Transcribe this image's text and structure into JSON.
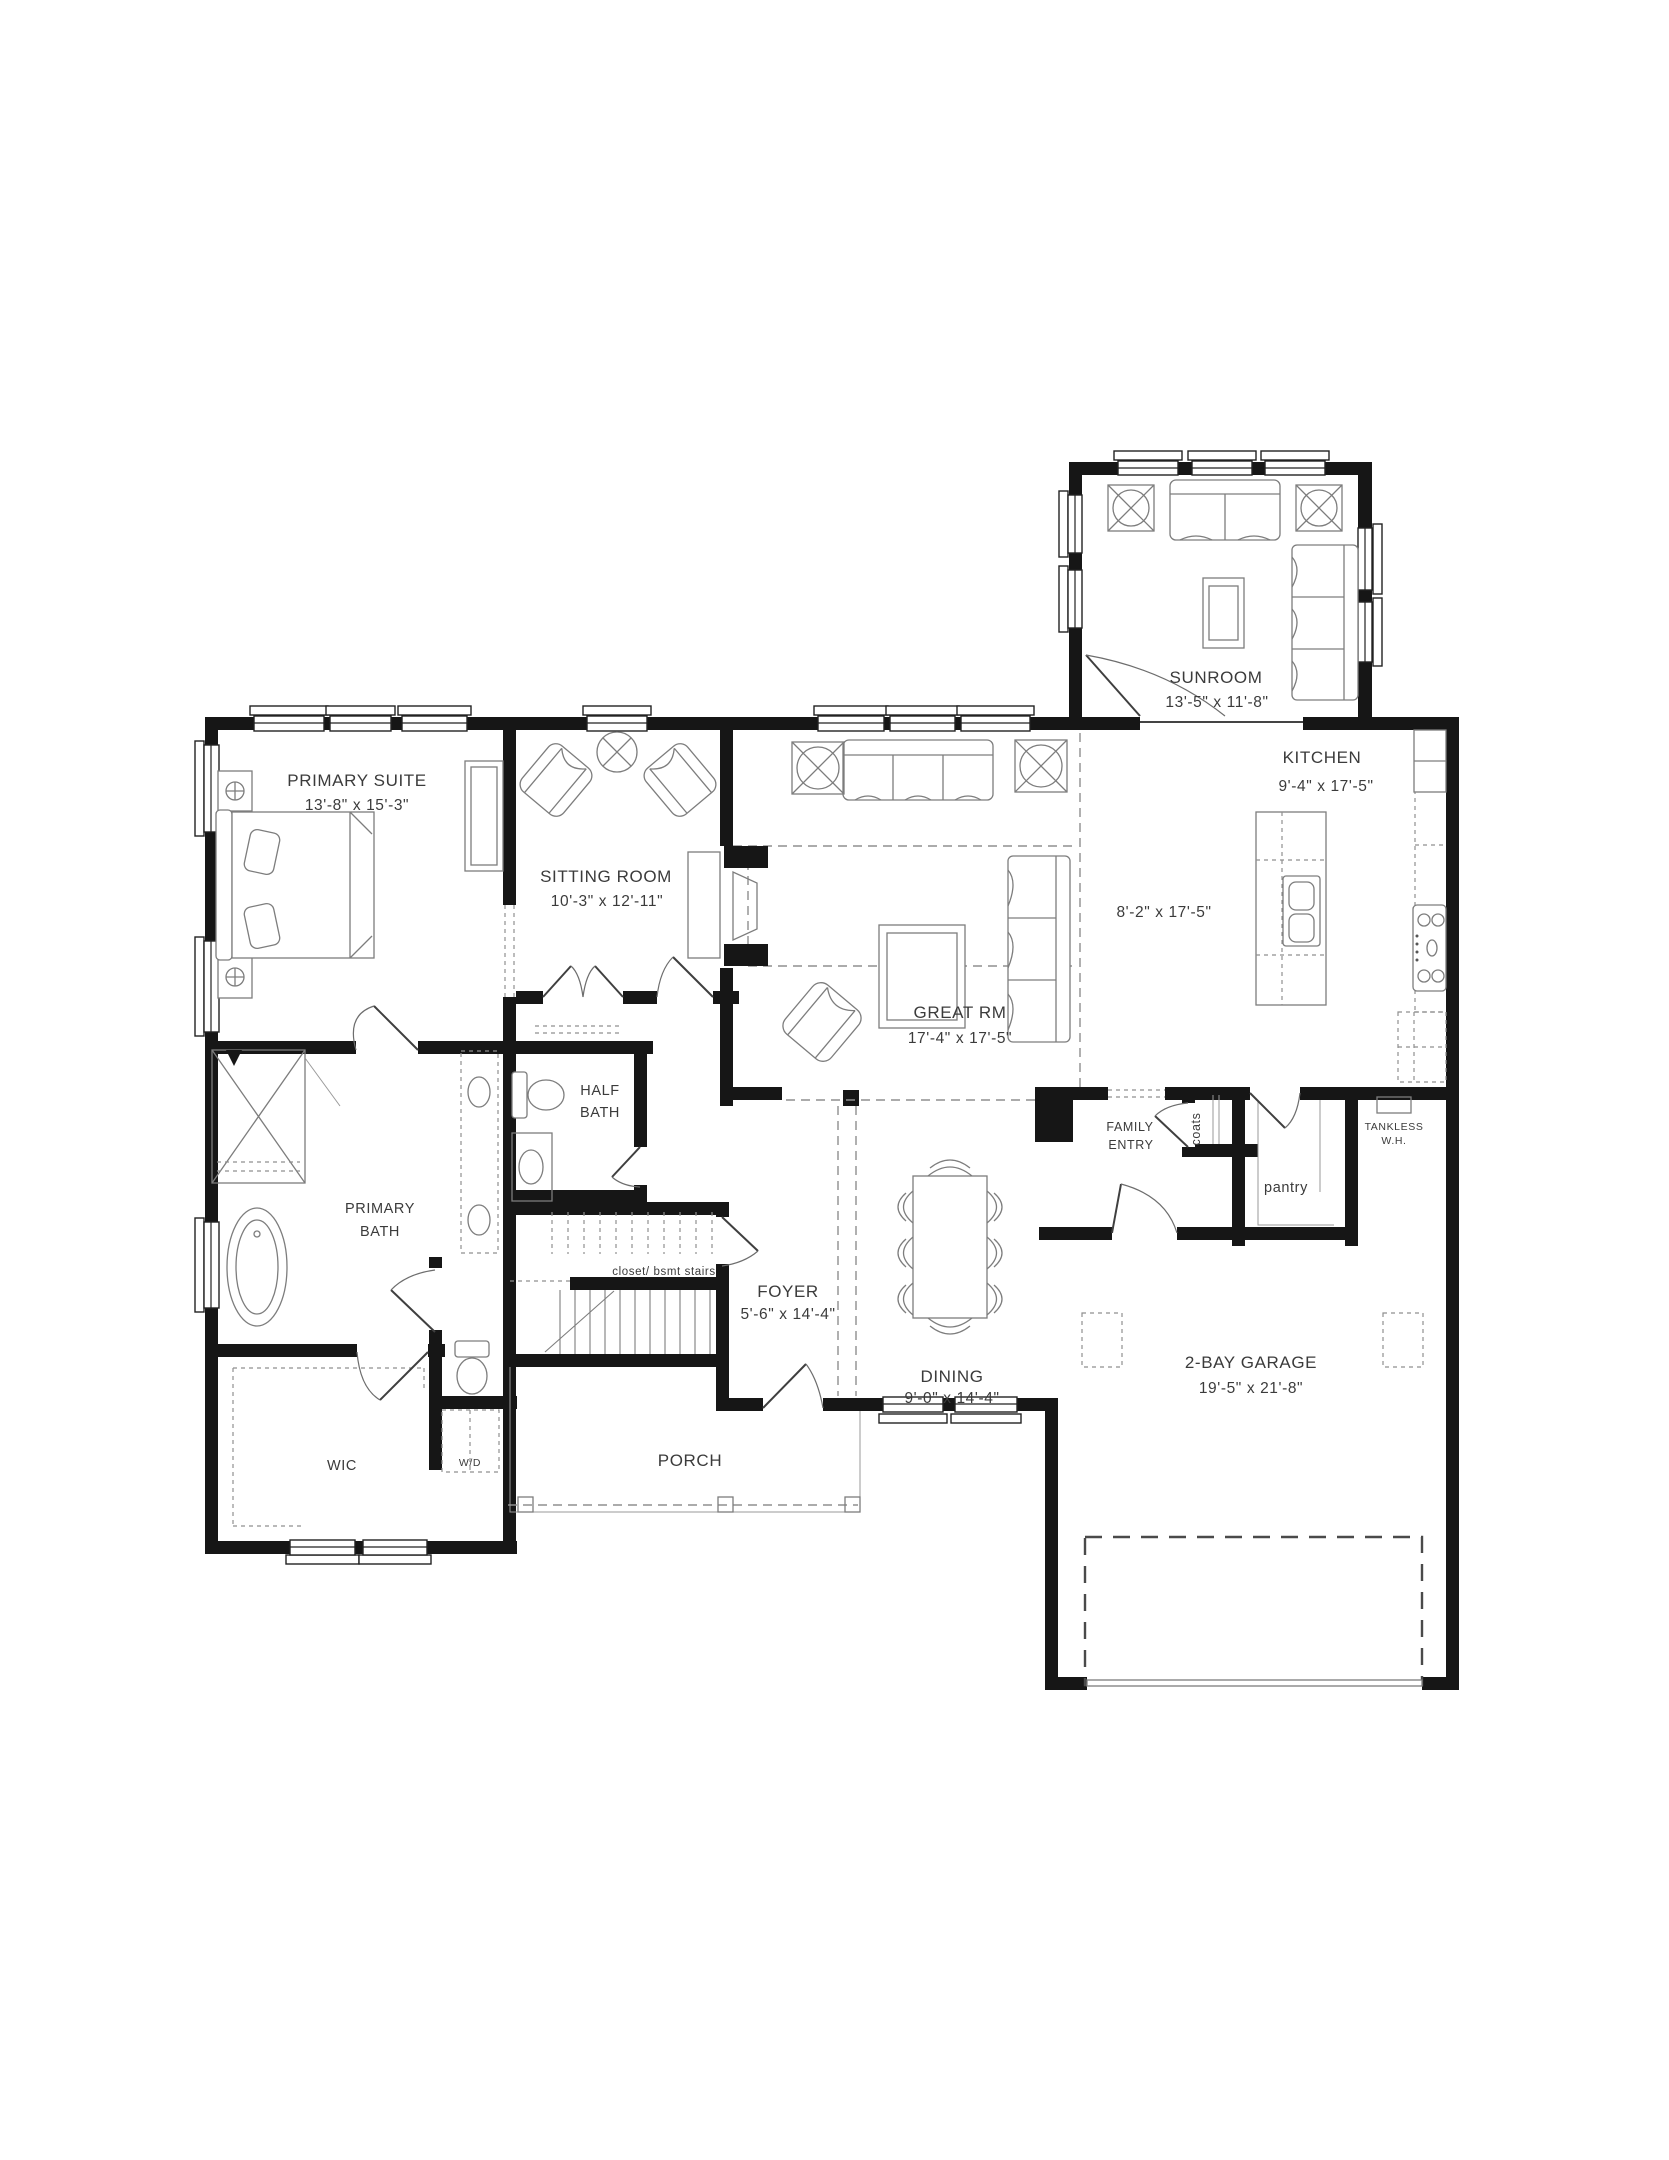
{
  "rooms": [
    {
      "name": "PRIMARY SUITE",
      "dims": "13'-8\" x 15'-3\""
    },
    {
      "name": "SITTING ROOM",
      "dims": "10'-3\" x 12'-11\""
    },
    {
      "name": "SUNROOM",
      "dims": "13'-5\" x 11'-8\""
    },
    {
      "name": "KITCHEN",
      "dims": "9'-4\" x 17'-5\""
    },
    {
      "name": "GREAT RM",
      "dims": "17'-4\" x 17'-5\""
    },
    {
      "name": "FOYER",
      "dims": "5'-6\" x 14'-4\""
    },
    {
      "name": "DINING",
      "dims": "9'-0\" x 14'-4\""
    },
    {
      "name": "2-BAY GARAGE",
      "dims": "19'-5\" x 21'-8\""
    },
    {
      "name": "PORCH"
    },
    {
      "name": "WIC"
    },
    {
      "name": "PRIMARY BATH",
      "lines": [
        "PRIMARY",
        "BATH"
      ]
    },
    {
      "name": "HALF BATH",
      "lines": [
        "HALF",
        "BATH"
      ]
    },
    {
      "name": "FAMILY ENTRY",
      "lines": [
        "FAMILY",
        "ENTRY"
      ]
    }
  ],
  "annotations": {
    "kitchen_aisle_dims": "8'-2\" x 17'-5\"",
    "coats": "coats",
    "pantry": "pantry",
    "tankless": {
      "lines": [
        "TANKLESS",
        "W.H."
      ]
    },
    "stair_closet": "closet/ bsmt stairs",
    "washer_dryer": "W/D"
  }
}
